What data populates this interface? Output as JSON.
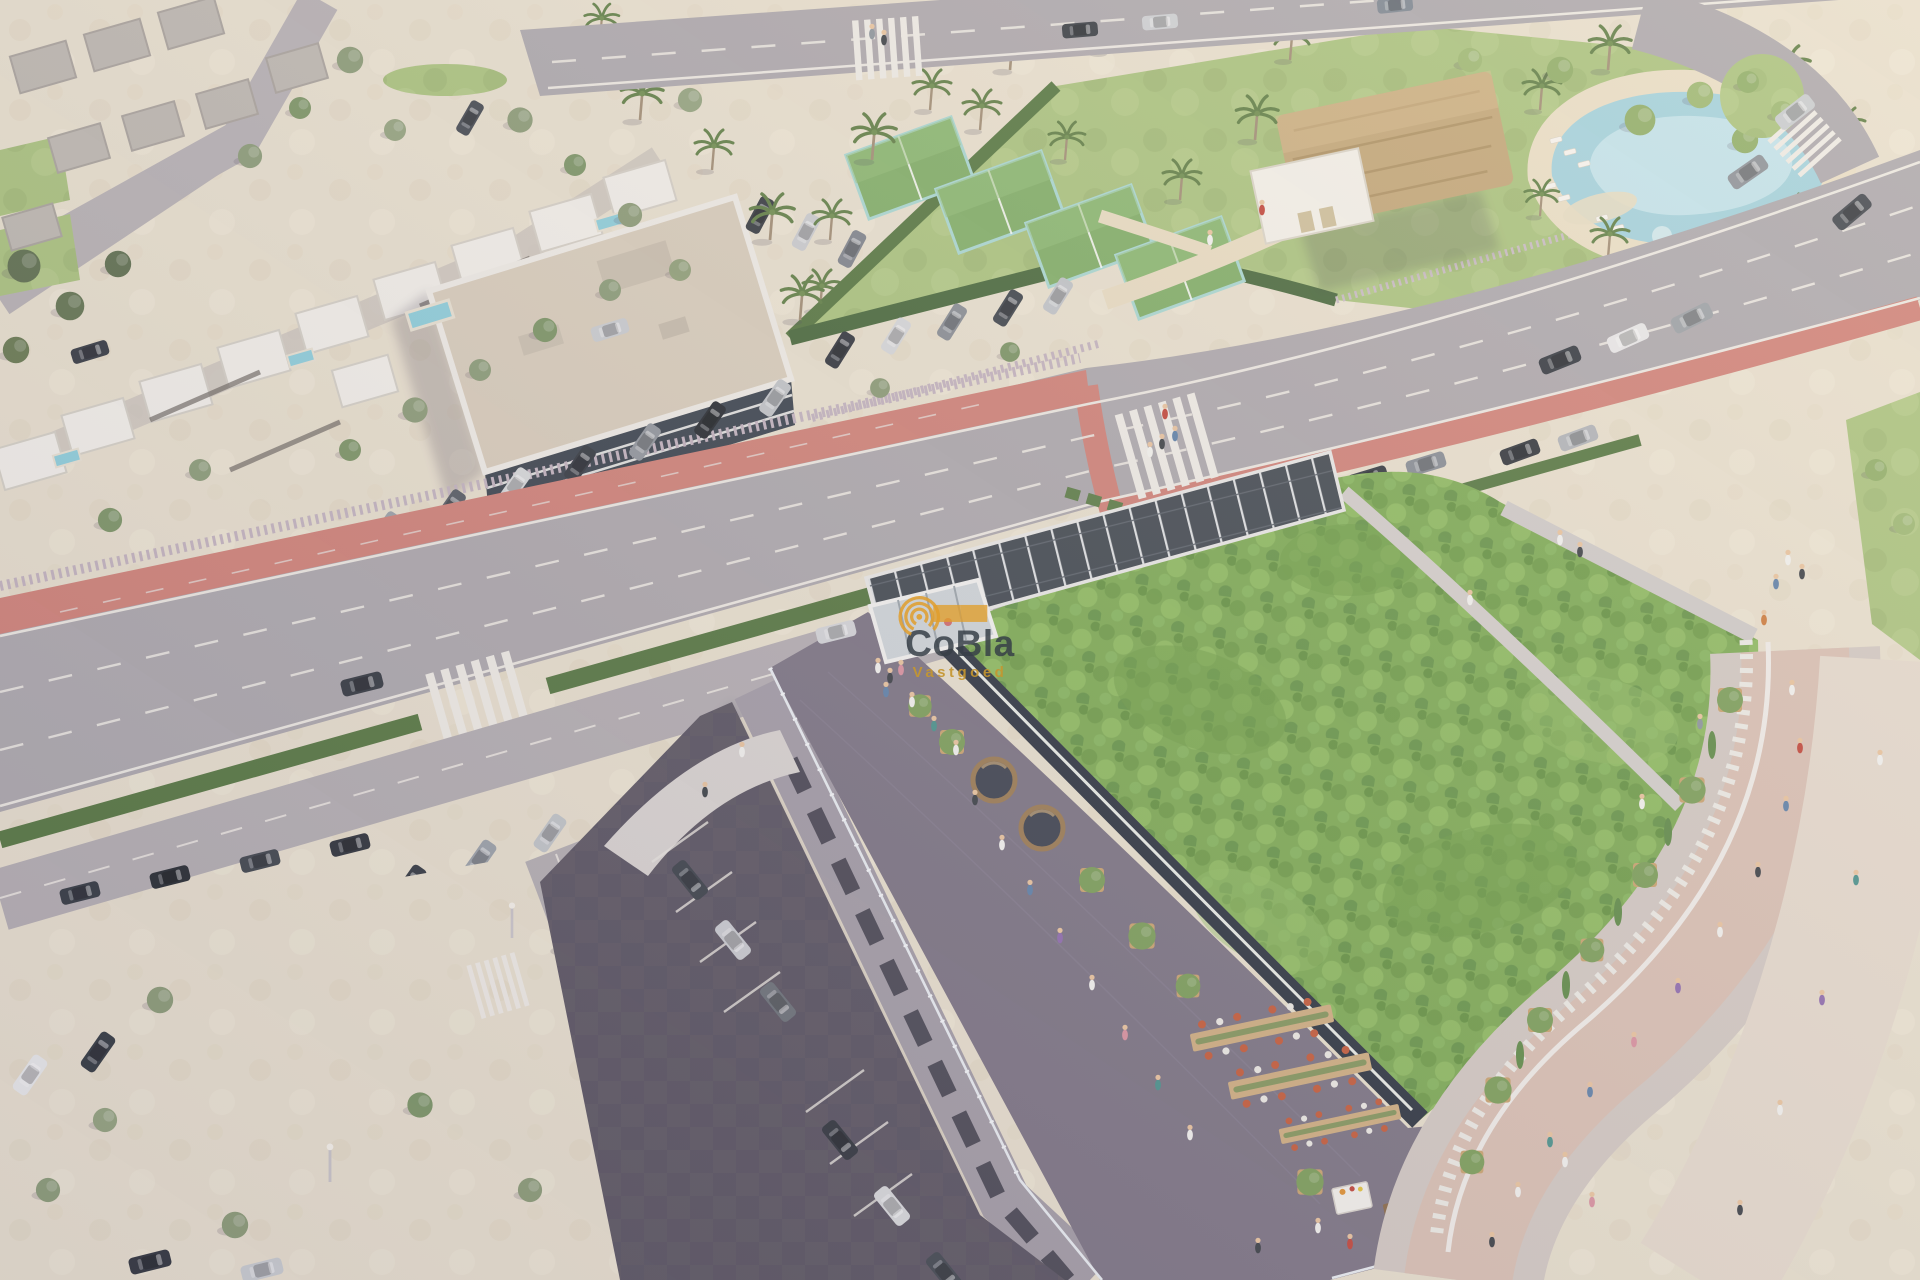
{
  "watermark": {
    "brand": "CoBla",
    "subtitle": "Vastgoed",
    "logo": "concentric-arcs-logo"
  },
  "palette": {
    "road": "#aca8ad",
    "road_markings": "#ece9e2",
    "bike_lane": "#d08177",
    "sand_plaza": "#e8e0ce",
    "lawn": "#a9c37d",
    "green_roof": "#7cab53",
    "hedge": "#54763f",
    "terrace_deck": "#7b7383",
    "parapet": "#2b333f",
    "building_wall": "#a29ca6",
    "asphalt_parking": "#5b5661",
    "promenade": "#d9c0b3",
    "walkway": "#cfcbc9",
    "pool_water": "#a2d2de",
    "pool_sand": "#eadfc6",
    "thatch_roof": "#c2a677",
    "clubhouse_white": "#f3f1ea",
    "solar_canopy": "#3f474f",
    "fence": "#c2b3bf",
    "apartment_facade": "#39424d",
    "apartment_roof": "#d8cdbb",
    "villa_white": "#f2f0ea",
    "watermark_brand": "rgba(55,63,72,0.85)",
    "watermark_subtitle": "rgba(196,150,48,0.92)",
    "watermark_logo_bar": "rgba(224,158,44,0.78)",
    "watermark_logo": "#e0a03c"
  },
  "scene": {
    "description": "Aerial render: commercial building with planted green roof, rooftop solar canopy and dining terraces; sports club with padel courts, thatched clubhouse and lagoon pool; villas, roads with red cycle lane, street parking and plazas.",
    "regions": [
      "residential-villas",
      "apartment-building",
      "sports-complex",
      "lagoon-pool",
      "main-road",
      "bike-lane",
      "green-roof",
      "solar-canopy",
      "dining-terrace",
      "promenade",
      "parking-lots",
      "sand-plaza"
    ]
  }
}
